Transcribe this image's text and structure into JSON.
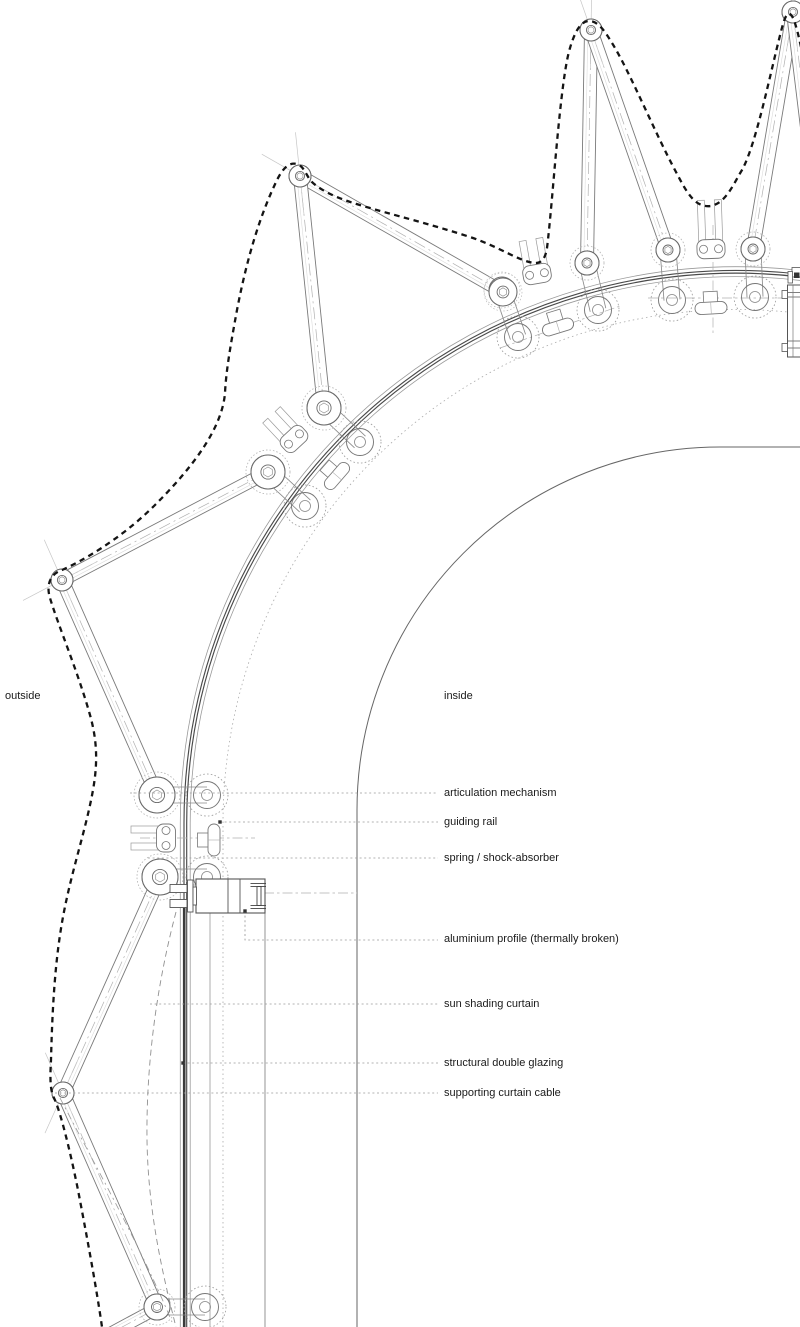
{
  "page": {
    "background": "#ffffff",
    "width": 800,
    "height": 1327
  },
  "labels": {
    "outside": {
      "text": "outside",
      "x": 5,
      "y": 699
    },
    "inside": {
      "text": "inside",
      "x": 444,
      "y": 699
    },
    "callouts": [
      {
        "id": "articulation-mechanism",
        "text": "articulation mechanism",
        "x": 444,
        "y": 796,
        "leader": [
          [
            130,
            793
          ],
          [
            438,
            793
          ]
        ],
        "marker": null
      },
      {
        "id": "guiding-rail",
        "text": "guiding rail",
        "x": 444,
        "y": 825,
        "leader": [
          [
            220,
            822
          ],
          [
            438,
            822
          ]
        ],
        "marker": [
          220,
          822
        ]
      },
      {
        "id": "spring-shock-absorber",
        "text": "spring / shock-absorber",
        "x": 444,
        "y": 861,
        "leader": [
          [
            148,
            858
          ],
          [
            438,
            858
          ]
        ],
        "marker": null
      },
      {
        "id": "aluminium-profile",
        "text": "aluminium profile (thermally broken)",
        "x": 444,
        "y": 942,
        "leader": [
          [
            245,
            911
          ],
          [
            245,
            940
          ],
          [
            438,
            940
          ]
        ],
        "marker": [
          245,
          911
        ]
      },
      {
        "id": "sun-shading-curtain",
        "text": "sun shading curtain",
        "x": 444,
        "y": 1007,
        "leader": [
          [
            150,
            1004
          ],
          [
            438,
            1004
          ]
        ],
        "marker": null
      },
      {
        "id": "structural-double-glazing",
        "text": "structural double glazing",
        "x": 444,
        "y": 1066,
        "leader": [
          [
            183,
            1063
          ],
          [
            438,
            1063
          ]
        ],
        "marker": [
          183,
          1063
        ]
      },
      {
        "id": "supporting-curtain-cable",
        "text": "supporting curtain cable",
        "x": 444,
        "y": 1096,
        "leader": [
          [
            55,
            1093
          ],
          [
            438,
            1093
          ]
        ],
        "marker": null
      }
    ]
  },
  "style": {
    "ink": "#1a1a1a",
    "arm_stroke": "#7a7a7a",
    "arm_thin": "#dcdcdc",
    "centerline": "#b0b0b0",
    "rail_dark": "#4a4a4a",
    "rail_light": "#9a9a9a",
    "dotted": "#aaaaaa",
    "leader": "#9b9b9b",
    "marker": "#333333",
    "envelope": "#141414",
    "curtain": "#909090",
    "wall": "#666666",
    "font_px": 11
  },
  "geometry": {
    "railCenter": [
      736.6,
      823.1
    ],
    "railEndAngle": 277,
    "railArcs": [
      {
        "r": 556.3,
        "c": "#9a9a9a",
        "w": 0.8
      },
      {
        "r": 552.6,
        "c": "#4a4a4a",
        "w": 1.15
      },
      {
        "r": 549.9,
        "c": "#4a4a4a",
        "w": 1.15
      },
      {
        "r": 546.4,
        "c": "#9a9a9a",
        "w": 0.8
      }
    ],
    "dottedArcR": 513.6,
    "innerWall": {
      "cx": 720,
      "cy": 810,
      "r": 363,
      "xTan": 357,
      "yTan": 447
    },
    "glazingBand": {
      "x": 184.2,
      "y1": 908,
      "y2": 1327,
      "w": 2.6,
      "c": "#3a3a3a"
    },
    "verticals": [
      {
        "x": 210,
        "y1": 913,
        "y2": 1327,
        "c": "#999999",
        "w": 0.8
      },
      {
        "x": 265,
        "y1": 913,
        "y2": 1327,
        "c": "#888888",
        "w": 0.9
      }
    ],
    "dashdotLines": [
      [
        140,
        838,
        255,
        838
      ],
      [
        190,
        893,
        357,
        893
      ],
      [
        713,
        225,
        713,
        335
      ],
      [
        648,
        298,
        790,
        298
      ],
      [
        500,
        348,
        620,
        306
      ]
    ],
    "arms": [
      [
        300,
        176,
        503,
        292,
        11,
        14
      ],
      [
        300,
        176,
        324,
        408,
        11,
        17
      ],
      [
        62,
        580,
        268,
        472,
        11,
        17
      ],
      [
        62,
        580,
        157,
        795,
        11,
        18
      ],
      [
        63,
        1093,
        160,
        877,
        11,
        18
      ],
      [
        63,
        1093,
        157,
        1307,
        11,
        13
      ],
      [
        591,
        30,
        587,
        263,
        11,
        12
      ],
      [
        591,
        30,
        668,
        250,
        11,
        12
      ],
      [
        793,
        12,
        753,
        249,
        11,
        12
      ],
      [
        793,
        12,
        821,
        243,
        11,
        12
      ],
      [
        150,
        1312,
        98,
        1340,
        0,
        0
      ]
    ],
    "stations": [
      {
        "hubs": [
          [
            157,
            795,
            18
          ],
          [
            160,
            877,
            18
          ]
        ],
        "rollers": [
          [
            207,
            795
          ],
          [
            207,
            877
          ]
        ],
        "links": [
          [
            157,
            795,
            207,
            795
          ],
          [
            160,
            877,
            207,
            877
          ]
        ],
        "fork": [
          166,
          838,
          270,
          26
        ],
        "spring": [
          214,
          840,
          0
        ]
      },
      {
        "hubs": [
          [
            324,
            408,
            17
          ],
          [
            268,
            472,
            17
          ]
        ],
        "rollers": [
          [
            360,
            442
          ],
          [
            305,
            506
          ]
        ],
        "links": [
          [
            324,
            408,
            360,
            442
          ],
          [
            268,
            472,
            305,
            506
          ]
        ],
        "fork": [
          294,
          439,
          317,
          24
        ],
        "spring": [
          337,
          476,
          41
        ]
      },
      {
        "hubs": [
          [
            587,
            263,
            12
          ],
          [
            502,
            290,
            13
          ]
        ],
        "rollers": [
          [
            598,
            310
          ],
          [
            518,
            337
          ]
        ],
        "links": [
          [
            587,
            263,
            598,
            310
          ],
          [
            502,
            290,
            518,
            337
          ]
        ],
        "fork": [
          537,
          274,
          350,
          26
        ],
        "spring": [
          558,
          327,
          73
        ]
      },
      {
        "hubs": [
          [
            668,
            250,
            12
          ],
          [
            753,
            249,
            12
          ]
        ],
        "rollers": [
          [
            672,
            300
          ],
          [
            755,
            297
          ]
        ],
        "links": [
          [
            668,
            250,
            672,
            300
          ],
          [
            753,
            249,
            755,
            297
          ]
        ],
        "fork": [
          711,
          249,
          358,
          40
        ],
        "spring": [
          711,
          308,
          87
        ]
      },
      {
        "hubs": [
          [
            157,
            1307,
            13
          ]
        ],
        "rollers": [
          [
            205,
            1307
          ]
        ],
        "links": [
          [
            157,
            1307,
            205,
            1307
          ]
        ],
        "fork": null,
        "spring": null
      }
    ],
    "profile": {
      "outer": [
        196,
        879,
        69,
        34
      ],
      "innerVerticals": [
        228,
        240
      ],
      "ibeamLines": [
        [
          250.5,
          883.5,
          266,
          883.5
        ],
        [
          250.5,
          886.5,
          266,
          886.5
        ],
        [
          250.5,
          905.5,
          266,
          905.5
        ],
        [
          250.5,
          908.5,
          266,
          908.5
        ]
      ],
      "web": [
        257,
        886.5,
        4,
        19
      ],
      "clampRects": [
        [
          170,
          884.5,
          17,
          8
        ],
        [
          170,
          899.5,
          17,
          8
        ],
        [
          187.5,
          880,
          5.5,
          32
        ],
        [
          193,
          887,
          3.5,
          18
        ]
      ]
    },
    "edgeBox": {
      "outer": [
        787.5,
        285,
        26,
        72
      ],
      "hLines": [
        [
          787.5,
          292.5,
          813,
          292.5
        ],
        [
          787.5,
          297,
          813,
          297
        ],
        [
          787.5,
          341,
          813,
          341
        ],
        [
          787.5,
          348,
          813,
          348
        ]
      ],
      "vLine": [
        793,
        285,
        793,
        357
      ],
      "tabs": [
        [
          782,
          290.5,
          5.5,
          8
        ],
        [
          782,
          343.5,
          5.5,
          8
        ],
        [
          792,
          267.5,
          12,
          9.5
        ],
        [
          788,
          271.5,
          4.5,
          11.5
        ]
      ],
      "darkBlob": [
        794,
        272.5,
        5.5,
        5.5
      ]
    },
    "envelopePath": "M 801 47 C 794 14 789 4 783 24 C 772 64 757 143 742 170 C 734 183 726 203 711 206 C 695 208 687 193 676 172 C 655 133 629 70 612 43 C 603 28 597 21 589 21 C 581 21 575 31 570 48 C 560 80 553 200 547 248 C 545 260 541 263 535 263 C 520 262 500 247 470 237 C 430 224 390 214 370 208 C 345 201 322 193 310 180 C 305 172 303 166 297 164 C 289 162 283 168 277 180 C 260 215 247 258 237 310 C 230 348 226 372 225 393 C 222 430 190 470 155 505 C 120 540 80 562 62 570 C 50 574 46 585 50 598 C 58 625 78 672 90 715 C 97 740 98 762 93 790 C 85 835 68 880 60 935 C 54 975 52 1020 51 1060 C 50 1078 50 1090 54 1098 C 60 1110 70 1150 78 1190 C 86 1232 96 1285 102 1327",
    "curtainPath": "M 176 912 C 158 980 146 1060 147 1140 C 148 1210 162 1272 176 1327",
    "cablePath": "M 60 1098 C 95 1165 140 1245 172 1322"
  }
}
